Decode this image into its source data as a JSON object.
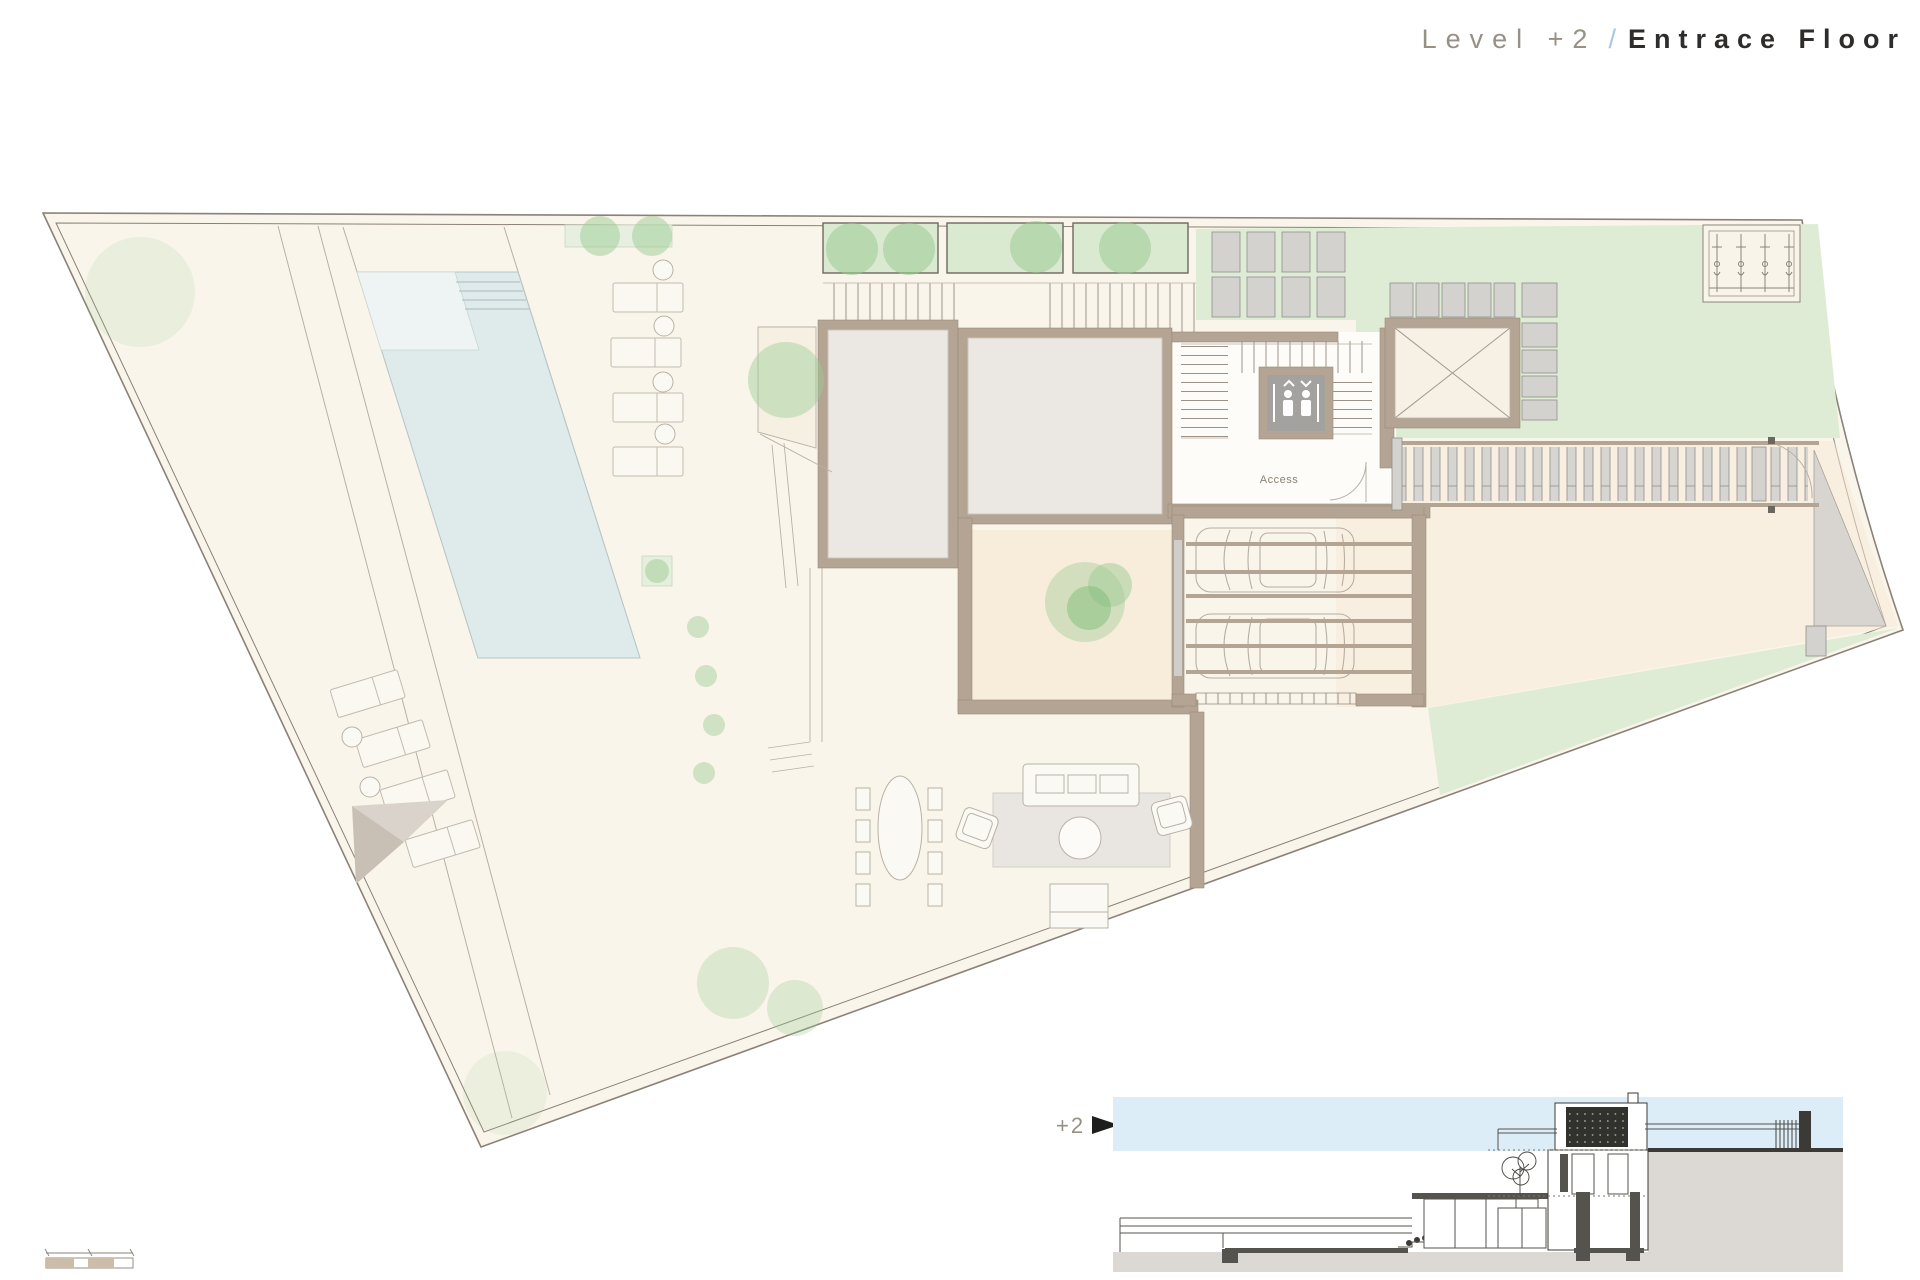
{
  "title": {
    "level": "Level +2",
    "separator": "/",
    "name": "Entrace Floor"
  },
  "plan": {
    "access_label": "Access"
  },
  "section": {
    "level_label": "+2"
  },
  "palette": {
    "site": "#faf5ea",
    "line": "#8b8177",
    "pool": "#dfeaeb",
    "lawn": "#dfecd5",
    "planter": "#d9ead0",
    "tree": "#9ccb94",
    "wall": "#b3a493",
    "room": "#ebe8e4",
    "slab": "#d3d2cf",
    "peach": "#f8ecdb",
    "sky": "#dcedf8",
    "ground": "#dcd8d3",
    "dark": "#3c3a36",
    "rug": "#e9e5e0",
    "tgray": "#988f85",
    "tdark": "#2f2d2b",
    "tblue": "#a9c6df",
    "access": "#8d8276"
  }
}
